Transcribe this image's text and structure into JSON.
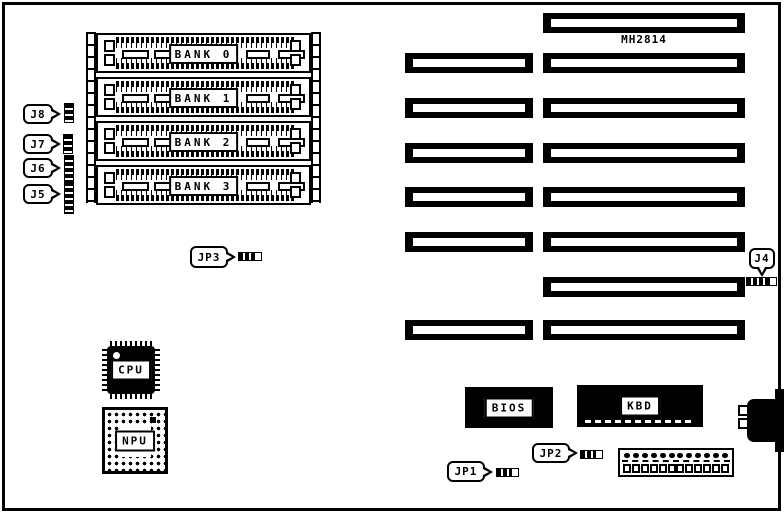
{
  "board": {
    "model": "MH2814",
    "banks": [
      "BANK 0",
      "BANK 1",
      "BANK 2",
      "BANK 3"
    ],
    "jumpers": {
      "j8": "J8",
      "j7": "J7",
      "j6": "J6",
      "j5": "J5",
      "jp3": "JP3",
      "jp1": "JP1",
      "jp2": "JP2",
      "j4": "J4"
    },
    "chips": {
      "cpu": "CPU",
      "npu": "NPU",
      "bios": "BIOS",
      "kbd": "KBD"
    },
    "expansion_slots": {
      "left_column": 6,
      "right_column": 8
    },
    "keyboard_header": {
      "pin_count": 12
    },
    "colors": {
      "ink": "#000000",
      "background": "#ffffff"
    }
  }
}
